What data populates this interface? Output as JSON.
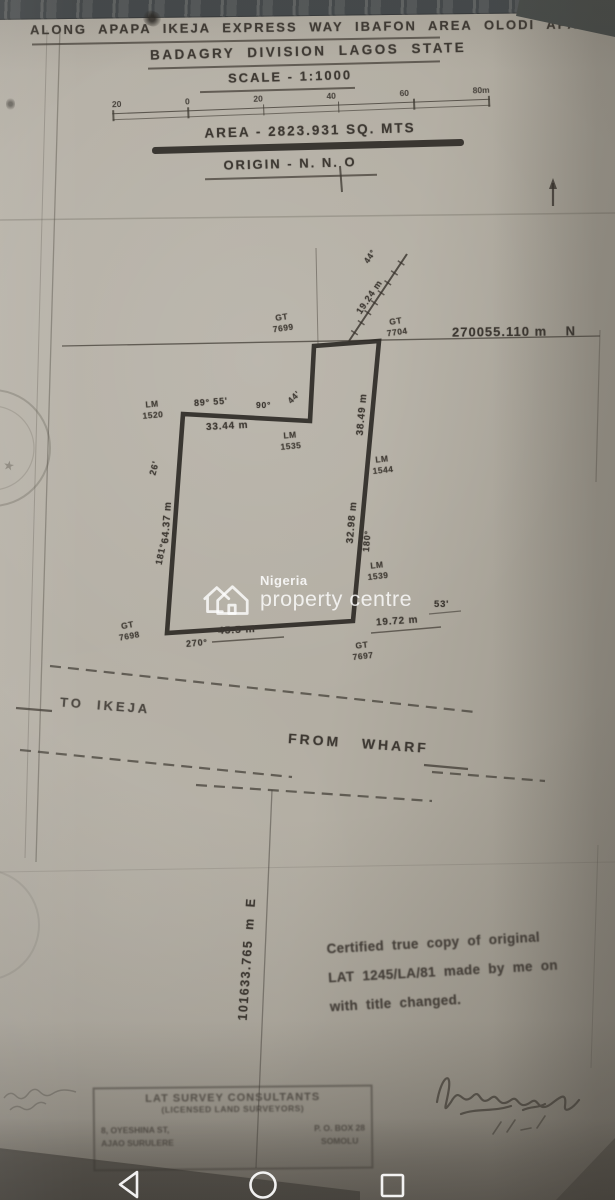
{
  "header": {
    "location_line": "ALONG APAPA IKEJA EXPRESS WAY IBAFON AREA OLODI APA",
    "division_line": "BADAGRY DIVISION LAGOS STATE",
    "scale_line": "SCALE - 1:1000",
    "scale_bar_labels": [
      "20",
      "0",
      "20",
      "40",
      "60",
      "80m"
    ],
    "area_line": "AREA - 2823.931 SQ. MTS",
    "origin_line": "ORIGIN - N. N. O"
  },
  "grid": {
    "northing_label": "270055.110 m    N",
    "easting_label": "101633.765  m  E"
  },
  "parcel": {
    "beacons": [
      {
        "type": "GT",
        "num": "7699"
      },
      {
        "type": "GT",
        "num": "7704"
      },
      {
        "type": "LM",
        "num": "1520"
      },
      {
        "type": "LM",
        "num": "1535"
      },
      {
        "type": "LM",
        "num": "1544"
      },
      {
        "type": "LM",
        "num": "1539"
      },
      {
        "type": "GT",
        "num": "7698"
      },
      {
        "type": "GT",
        "num": "7697"
      }
    ],
    "dimensions": {
      "top_bearing": "89° 55'",
      "top_angle": "90°",
      "top_angle2": "44'",
      "top_length": "33.44 m",
      "left_angle": "26'",
      "left_length": "64.37 m",
      "left_bearing": "181°",
      "right_upper_length": "38.49 m",
      "right_lower_length": "32.98 m",
      "right_bearing": "180°",
      "bottom_length": "45.5 m",
      "bottom_bearing": "270°",
      "tie_bearing": "53'",
      "tie_length": "19.72 m",
      "diagonal_length": "19.24 m",
      "diagonal_bearing": "44°"
    }
  },
  "roads": {
    "to_ikeja": "TO  IKEJA",
    "from_wharf": "FROM   WHARF"
  },
  "certification": {
    "line1": "Certified true copy of original",
    "line2": "LAT 1245/LA/81 made by me on",
    "line3": "with title changed."
  },
  "stamp": {
    "line1": "LAT  SURVEY  CONSULTANTS",
    "line2": "(LICENSED  LAND  SURVEYORS)",
    "left1": "8, OYESHINA ST,",
    "left2": "AJAO SURULERE",
    "right1": "P. O. BOX 28",
    "right2": "SOMOLU"
  },
  "watermark": {
    "brand_top": "Nigeria",
    "brand_bottom": "property centre"
  },
  "colors": {
    "ink": "#3d3832",
    "paper": "#b3ada2",
    "watermark": "#ffffff"
  }
}
